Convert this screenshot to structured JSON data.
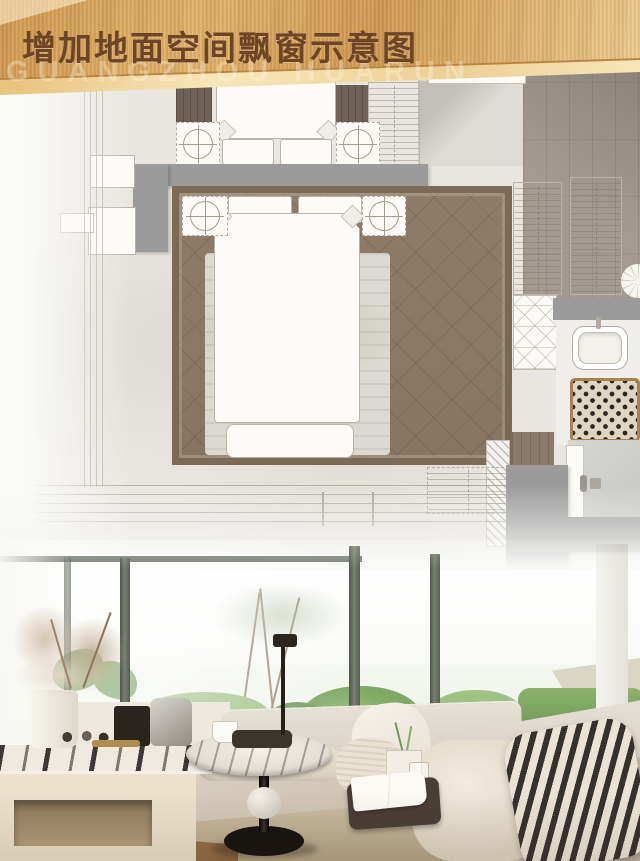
{
  "banner": {
    "title": "增加地面空间飘窗示意图",
    "watermark": "GUANGZHOU HUARUN"
  },
  "theme": {
    "gold_dark": "#d29a4f",
    "gold_mid": "#e2b269",
    "gold_pale": "#eecb8e",
    "ribbon_light": "#f7e6ba",
    "band_edge": "#b9853e",
    "title_brown": "#6d4526",
    "watermark_tint": "rgba(255,248,230,0.32)",
    "plan_tile": "#e9e6e1",
    "wall_gray": "#9b9b9b",
    "carpet_dark": "#7d6a56",
    "carpet_mid": "#8f7c68",
    "rug_light": "#dcd9d2",
    "wood_floor": "#a49b90",
    "wood_warm": "#8b7b68",
    "mat_border": "#a8814f",
    "mat_bg": "#ded5c2",
    "mat_dot": "#2a2620",
    "line_gray": "#a9a49b",
    "symbol_line": "#a59d8f",
    "mullion": "#67705f",
    "leaf_dark": "#5f8d49",
    "bush": "#7ea863",
    "bush_light": "#9ec184",
    "lawn": "#8fbf68",
    "rock_gray": "#b7bab2",
    "trunk": "#9b8a77",
    "cushion": "#d8d1c4",
    "cushion_dark": "#c3b8a4",
    "front_face": "#c9b99e",
    "pillow_cream": "#ece6d8",
    "zebra_dark": "#35322c",
    "tray_brown": "#493f35",
    "table_black": "#16130f",
    "console_cream": "#e9dfc9",
    "marble_light": "#efe9e0",
    "floor_brown": "#a8815a",
    "plume": "#d2c2ab"
  }
}
